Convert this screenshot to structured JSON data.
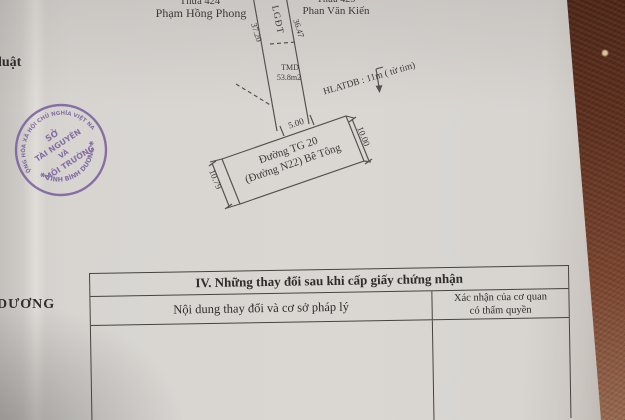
{
  "page": {
    "side_text_top": "luật",
    "side_text_bottom": "DƯƠNG"
  },
  "diagram": {
    "parcel_left_number": "Thửa 424",
    "owner_left": "Phạm Hồng Phong",
    "parcel_right_number": "Thửa 425",
    "owner_right": "Phan Văn Kiến",
    "strip_label": "LGĐT",
    "dim_strip_left": "37.20",
    "dim_strip_right": "36.47",
    "area_label": "TMD",
    "area_value": "53.8m2",
    "corridor_note": "HLATDB : 11m ( từ tim)",
    "dim_frontage": "5.00",
    "road_name_line1": "Đường TG 20",
    "road_name_line2": "(Đường N22) Bê Tông",
    "dim_road_right": "10.00",
    "dim_road_left": "10.79",
    "ink_color": "#52504c"
  },
  "stamp": {
    "arc_top": "CỘNG HÒA XÃ HỘI CHỦ NGHĨA VIỆT NAM",
    "arc_bottom": "✱ TỈNH BÌNH DƯƠNG ✱",
    "center_line1": "SỞ",
    "center_line2": "TÀI NGUYÊN",
    "center_line3": "VÀ",
    "center_line4": "MÔI TRƯỜNG",
    "ink_color": "#7b60a1"
  },
  "table": {
    "section_title": "IV. Những thay đổi sau khi cấp giấy chứng nhận",
    "col1_header": "Nội dung thay đổi và cơ sở pháp lý",
    "col2_header_line1": "Xác nhận của cơ quan",
    "col2_header_line2": "có thẩm quyền"
  }
}
